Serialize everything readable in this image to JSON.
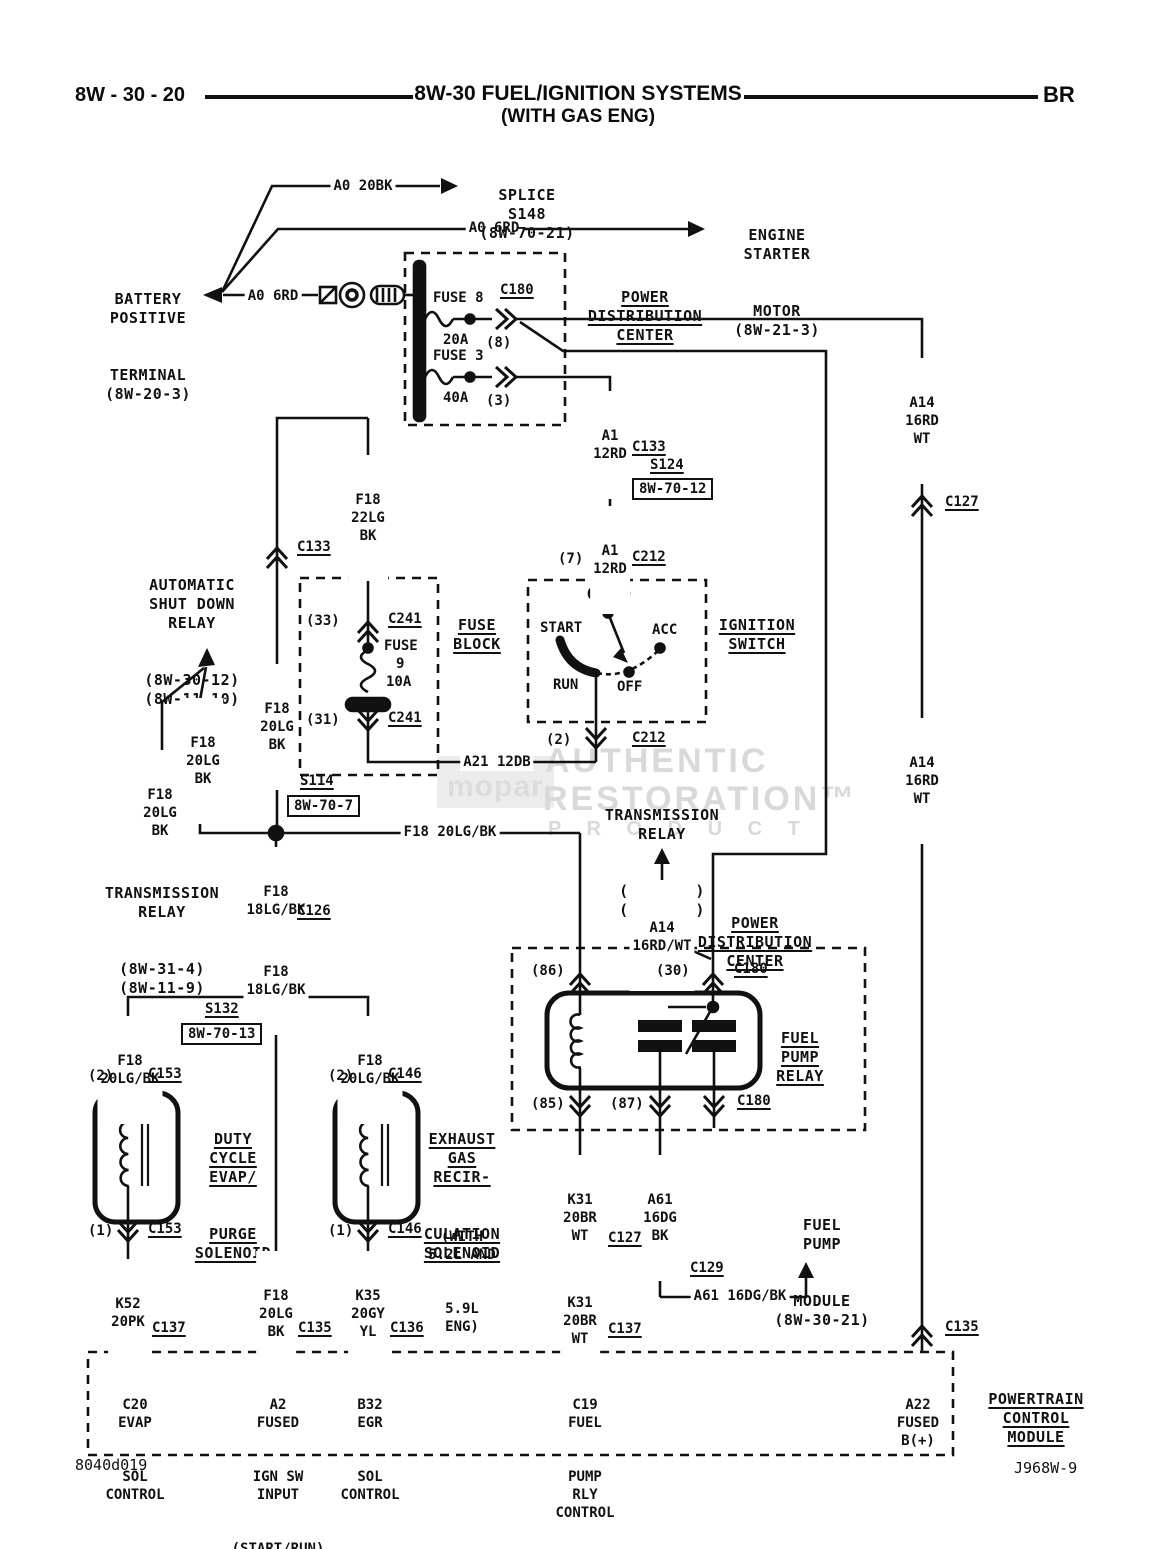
{
  "header": {
    "page_code": "8W - 30 - 20",
    "title": "8W-30 FUEL/IGNITION SYSTEMS",
    "subtitle": "(WITH GAS ENG)",
    "section": "BR"
  },
  "battery": {
    "lines": [
      "BATTERY",
      "POSITIVE",
      "TERMINAL",
      "(8W-20-3)"
    ],
    "wire": "A0 6RD"
  },
  "splice_s148": {
    "wire": "A0 20BK",
    "lines": [
      "SPLICE",
      "S148",
      "(8W-70-21)"
    ]
  },
  "starter": {
    "wire": "A0 6RD",
    "lines": [
      "ENGINE",
      "STARTER",
      "MOTOR",
      "(8W-21-3)"
    ]
  },
  "pdc_top": {
    "title": [
      "POWER",
      "DISTRIBUTION",
      "CENTER"
    ],
    "c180": "C180",
    "fuse8": {
      "name": "FUSE 8",
      "amp": "20A",
      "pin": "(8)"
    },
    "fuse3": {
      "name": "FUSE 3",
      "amp": "40A",
      "pin": "(3)"
    }
  },
  "right_col": {
    "wire_top": [
      "A14",
      "16RD",
      "WT"
    ],
    "c127": "C127",
    "wire_mid": [
      "A14",
      "16RD",
      "WT"
    ],
    "c135": "C135"
  },
  "center": {
    "wire_a1_top": [
      "A1",
      "12RD"
    ],
    "c133": "C133",
    "s124": "S124",
    "s124_ref": "8W-70-12",
    "wire_a1_bot": [
      "A1",
      "12RD"
    ],
    "pin7": "(7)",
    "c212": "C212"
  },
  "ignition": {
    "title": [
      "IGNITION",
      "SWITCH"
    ],
    "start": "START",
    "acc": "ACC",
    "run": "RUN",
    "off": "OFF",
    "pin2": "(2)",
    "c212": "C212",
    "wire_a21": "A21 12DB"
  },
  "fuse_block": {
    "title": [
      "FUSE",
      "BLOCK"
    ],
    "pin33": "(33)",
    "c241_top": "C241",
    "fuse9": [
      "FUSE",
      "9",
      "10A"
    ],
    "pin31": "(31)",
    "c241_bot": "C241",
    "wire_f18_22": [
      "F18",
      "22LG",
      "BK"
    ],
    "c133": "C133",
    "wire_f18_20": [
      "F18",
      "20LG",
      "BK"
    ]
  },
  "asd": {
    "lines": [
      "AUTOMATIC",
      "SHUT DOWN",
      "RELAY",
      "(8W-30-12)",
      "(8W-11-10)"
    ],
    "wire_mid": [
      "F18",
      "20LG",
      "BK"
    ],
    "wire_left": [
      "F18",
      "20LG",
      "BK"
    ]
  },
  "trans_left": {
    "lines": [
      "TRANSMISSION",
      "RELAY",
      "(8W-31-4)",
      "(8W-11-9)"
    ]
  },
  "s114": {
    "name": "S114",
    "ref": "8W-70-7",
    "wire_right": "F18 20LG/BK",
    "wire_down1": [
      "F18",
      "18LG/BK"
    ],
    "c126": "C126",
    "wire_down2": [
      "F18",
      "18LG/BK"
    ]
  },
  "s132": {
    "name": "S132",
    "ref": "8W-70-13",
    "wire_left": [
      "F18",
      "20LG/BK"
    ],
    "wire_right": [
      "F18",
      "20LG/BK"
    ]
  },
  "evap": {
    "pin2": "(2)",
    "c153_top": "C153",
    "title": [
      "DUTY",
      "CYCLE",
      "EVAP/",
      "PURGE",
      "SOLENOID"
    ],
    "pin1": "(1)",
    "c153_bot": "C153",
    "wire": [
      "K52",
      "20PK"
    ],
    "c137": "C137",
    "pcm_pin": [
      "C20",
      "EVAP",
      "SOL",
      "CONTROL"
    ]
  },
  "center_col": {
    "wire": [
      "F18",
      "20LG",
      "BK"
    ],
    "c135": "C135",
    "pcm_pin": [
      "A2",
      "FUSED",
      "IGN SW",
      "INPUT",
      "(START/RUN)"
    ]
  },
  "egr": {
    "pin2": "(2)",
    "c146_top": "C146",
    "title": [
      "EXHAUST",
      "GAS",
      "RECIR-",
      "CULATION",
      "SOLENOID"
    ],
    "note": [
      "(WITH",
      "5.2L AND",
      "5.9L",
      "ENG)"
    ],
    "pin1": "(1)",
    "c146_bot": "C146",
    "wire": [
      "K35",
      "20GY",
      "YL"
    ],
    "c136": "C136",
    "pcm_pin": [
      "B32",
      "EGR",
      "SOL",
      "CONTROL"
    ]
  },
  "trans_ref2": {
    "lines": [
      "TRANSMISSION",
      "RELAY",
      "(8W-31-4)",
      "(8W-11-9)"
    ],
    "wire": [
      "A14",
      "16RD/WT"
    ]
  },
  "pdc_relay": {
    "title": [
      "POWER",
      "DISTRIBUTION",
      "CENTER"
    ],
    "pin86": "(86)",
    "pin30": "(30)",
    "c180_top": "C180",
    "relay_title": [
      "FUEL",
      "PUMP",
      "RELAY"
    ],
    "pin85": "(85)",
    "pin87": "(87)",
    "c180_bot": "C180"
  },
  "k31": {
    "wire1": [
      "K31",
      "20BR",
      "WT"
    ],
    "c127": "C127",
    "wire2": [
      "K31",
      "20BR",
      "WT"
    ],
    "c137": "C137",
    "pcm_pin": [
      "C19",
      "FUEL",
      "PUMP",
      "RLY",
      "CONTROL"
    ]
  },
  "a61": {
    "wire1": [
      "A61",
      "16DG",
      "BK"
    ],
    "c129": "C129",
    "wire2": "A61 16DG/BK"
  },
  "fuel_pump_module": {
    "lines": [
      "FUEL",
      "PUMP",
      "MODULE",
      "(8W-30-21)"
    ]
  },
  "pcm": {
    "title": [
      "POWERTRAIN",
      "CONTROL",
      "MODULE"
    ],
    "b_plus": [
      "A22",
      "FUSED",
      "B(+)"
    ]
  },
  "watermark": {
    "logo": "mopar",
    "line1": "AUTHENTIC",
    "line2": "RESTORATION™",
    "line3": "P R O D U C T"
  },
  "footer": {
    "left": "8040d019",
    "right": "J968W-9"
  }
}
